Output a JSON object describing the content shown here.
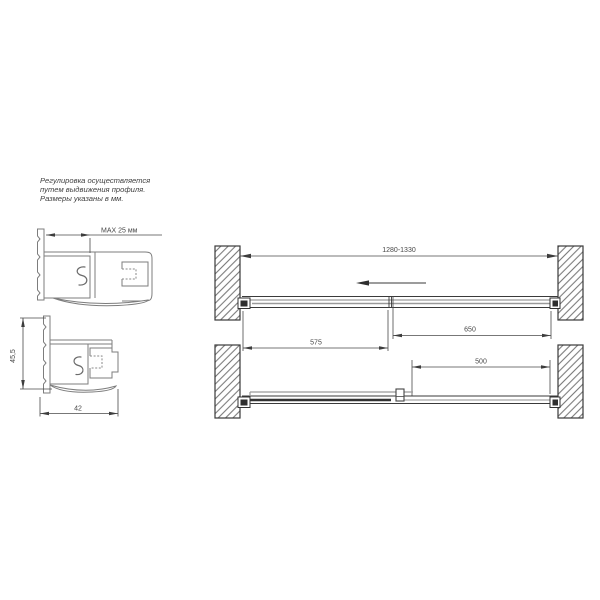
{
  "notes": {
    "line1": "Регулировка осуществляется",
    "line2": "путем выдвижения профиля.",
    "line3": "Размеры указаны в мм."
  },
  "profile_sections": {
    "max_extension_label": "MAX 25 мм",
    "height_label": "45,5",
    "width_label": "42"
  },
  "plan_views": {
    "overall_width_label": "1280-1330",
    "fixed_panel_label": "575",
    "door_panel_label": "650",
    "opening_label": "500"
  },
  "colors": {
    "background": "#ffffff",
    "profile_stroke": "#7d7d7d",
    "structure_stroke": "#3a3a3a",
    "dimension_color": "#474747",
    "panel_gray": "#9a9a9a",
    "bold_panel": "#2f2f2f"
  }
}
